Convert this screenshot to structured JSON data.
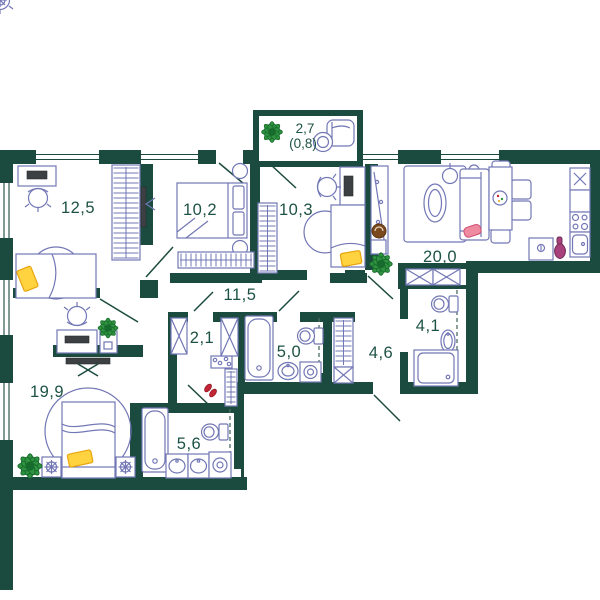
{
  "plan": {
    "title": "apartment floor plan",
    "rooms": [
      {
        "name": "bedroom-top-left",
        "area": "12,5"
      },
      {
        "name": "bedroom-top-middle",
        "area": "10,2"
      },
      {
        "name": "bedroom-top-right",
        "area": "10,3"
      },
      {
        "name": "kitchen-living-room",
        "area": "20,0"
      },
      {
        "name": "corridor",
        "area": "11,5"
      },
      {
        "name": "closet",
        "area": "2,1"
      },
      {
        "name": "bathroom-middle",
        "area": "5,0"
      },
      {
        "name": "entrance-hall",
        "area": "4,6"
      },
      {
        "name": "shower-room",
        "area": "4,1"
      },
      {
        "name": "bedroom-bottom-left",
        "area": "19,9"
      },
      {
        "name": "bathroom-bottom",
        "area": "5,6"
      },
      {
        "name": "balcony",
        "area": "2,7",
        "area_reduced": "(0,8)"
      }
    ],
    "fixtures": [
      "bed",
      "sofa",
      "bathtub",
      "toilet",
      "sink",
      "washing-machine",
      "stove",
      "fridge",
      "dining-table",
      "desk",
      "office-chair",
      "wardrobe",
      "plant",
      "tv",
      "shower",
      "armchair",
      "vase",
      "floor-lamp",
      "coat-rack",
      "shoes",
      "mirror"
    ],
    "colors": {
      "wall": "#1b4b3e",
      "furniture_outline": "#7277b5",
      "label_text": "#1d5244",
      "pillow_yellow": "#ffd23f",
      "pillow_pink": "#ef8ba1",
      "shoes_red": "#c22535",
      "plant_green": "#2f9240",
      "wood_brown": "#7a4a1e",
      "vase_magenta": "#a8407c"
    }
  }
}
